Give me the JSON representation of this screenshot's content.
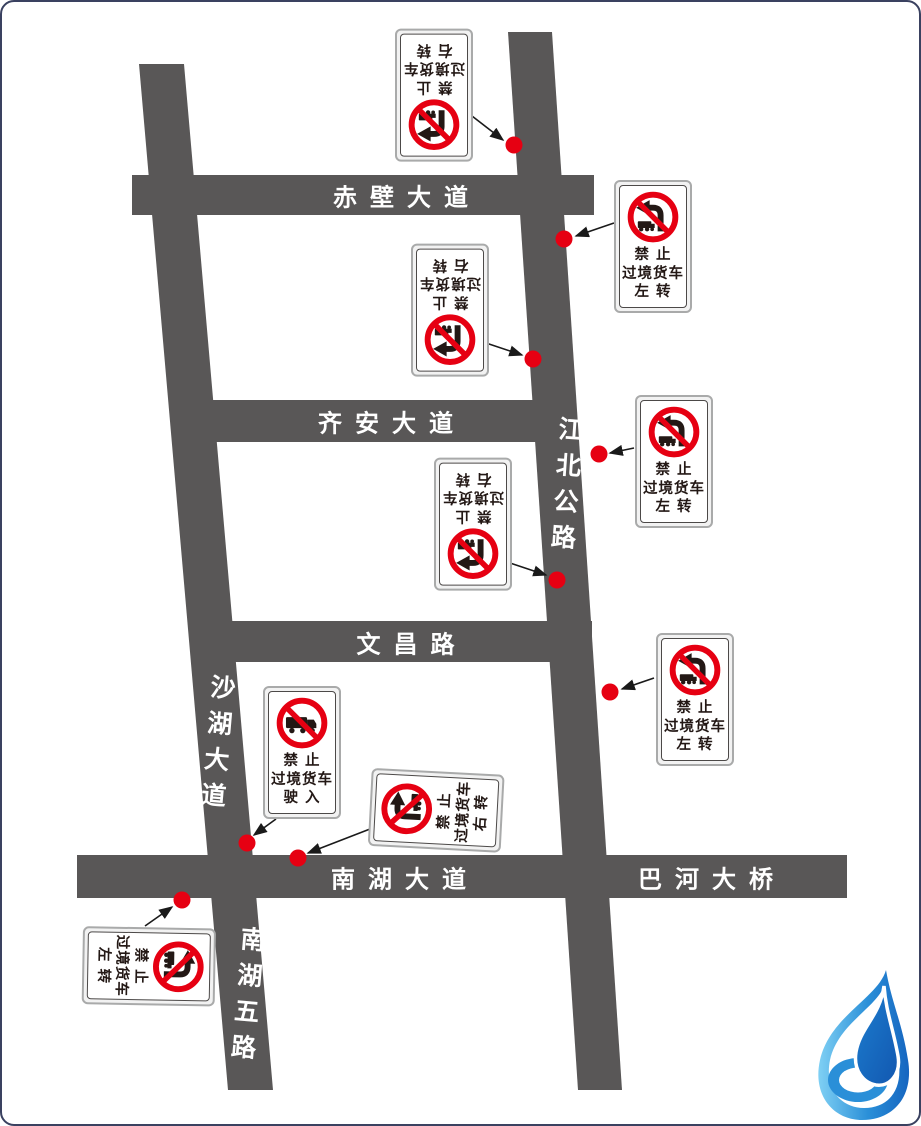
{
  "page": {
    "background": "#ffffff",
    "border_color": "#3a4160"
  },
  "roads": {
    "chibi_avenue": {
      "label": "赤壁大道"
    },
    "qian_avenue": {
      "label": "齐安大道"
    },
    "wenchang_road": {
      "label": "文昌路"
    },
    "nanhu_avenue": {
      "label": "南湖大道"
    },
    "bahe_bridge": {
      "label": "巴河大桥"
    },
    "shahu_avenue": {
      "label": "沙湖大道"
    },
    "nanhu_5th_road": {
      "label": "南湖五路"
    },
    "jiangbei_highway": {
      "label": "江北公路"
    }
  },
  "signs": [
    {
      "icon": "no-right-turn-truck-icon",
      "lines": [
        "禁 止",
        "过境货车",
        "右 转"
      ],
      "orientation_deg": 180
    },
    {
      "icon": "no-left-turn-truck-icon",
      "lines": [
        "禁 止",
        "过境货车",
        "左 转"
      ],
      "orientation_deg": 0
    },
    {
      "icon": "no-right-turn-truck-icon",
      "lines": [
        "禁 止",
        "过境货车",
        "右 转"
      ],
      "orientation_deg": 180
    },
    {
      "icon": "no-left-turn-truck-icon",
      "lines": [
        "禁 止",
        "过境货车",
        "左 转"
      ],
      "orientation_deg": 0
    },
    {
      "icon": "no-right-turn-truck-icon",
      "lines": [
        "禁 止",
        "过境货车",
        "右 转"
      ],
      "orientation_deg": 180
    },
    {
      "icon": "no-left-turn-truck-icon",
      "lines": [
        "禁 止",
        "过境货车",
        "左 转"
      ],
      "orientation_deg": 0
    },
    {
      "icon": "no-truck-entry-icon",
      "lines": [
        "禁 止",
        "过境货车",
        "驶 入"
      ],
      "orientation_deg": 0
    },
    {
      "icon": "no-right-turn-truck-icon",
      "lines": [
        "禁 止",
        "过境货车",
        "右 转"
      ],
      "orientation_deg": -87
    },
    {
      "icon": "no-left-turn-truck-icon",
      "lines": [
        "禁 止",
        "过境货车",
        "左 转"
      ],
      "orientation_deg": 91
    }
  ],
  "colors": {
    "road": "#595757",
    "road_text": "#ffffff",
    "prohibition_red": "#e60012",
    "sign_text": "#231815",
    "marker_dot": "#e60012",
    "arrow": "#1a1a1a",
    "logo_blue_light": "#45b6ea",
    "logo_blue_dark": "#1565c0"
  }
}
